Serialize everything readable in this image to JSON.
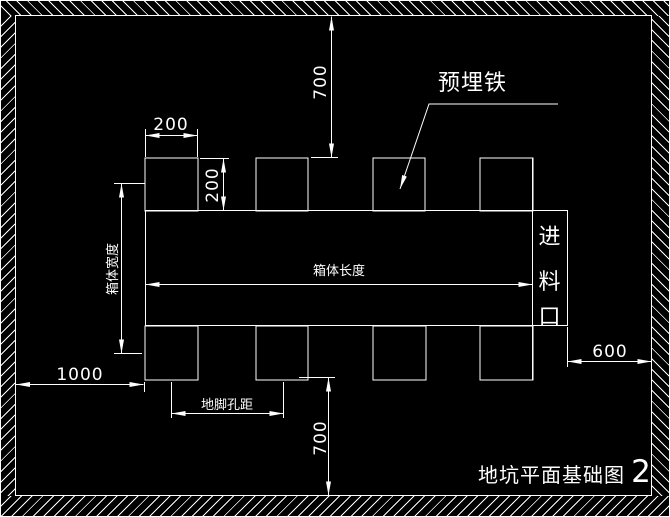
{
  "drawing": {
    "title_text": "地坑平面基础图",
    "title_number": "2",
    "labels": {
      "embedded_iron": "预埋铁",
      "feed_inlet": "进料口",
      "box_length": "箱体长度",
      "box_width": "箱体宽度",
      "anchor_hole_spacing": "地脚孔距"
    },
    "dimensions": {
      "top_offset": "700",
      "bottom_offset": "700",
      "block_width": "200",
      "block_height": "200",
      "left_offset": "1000",
      "right_offset": "600"
    },
    "colors": {
      "background": "#000000",
      "line": "#ffffff"
    }
  }
}
